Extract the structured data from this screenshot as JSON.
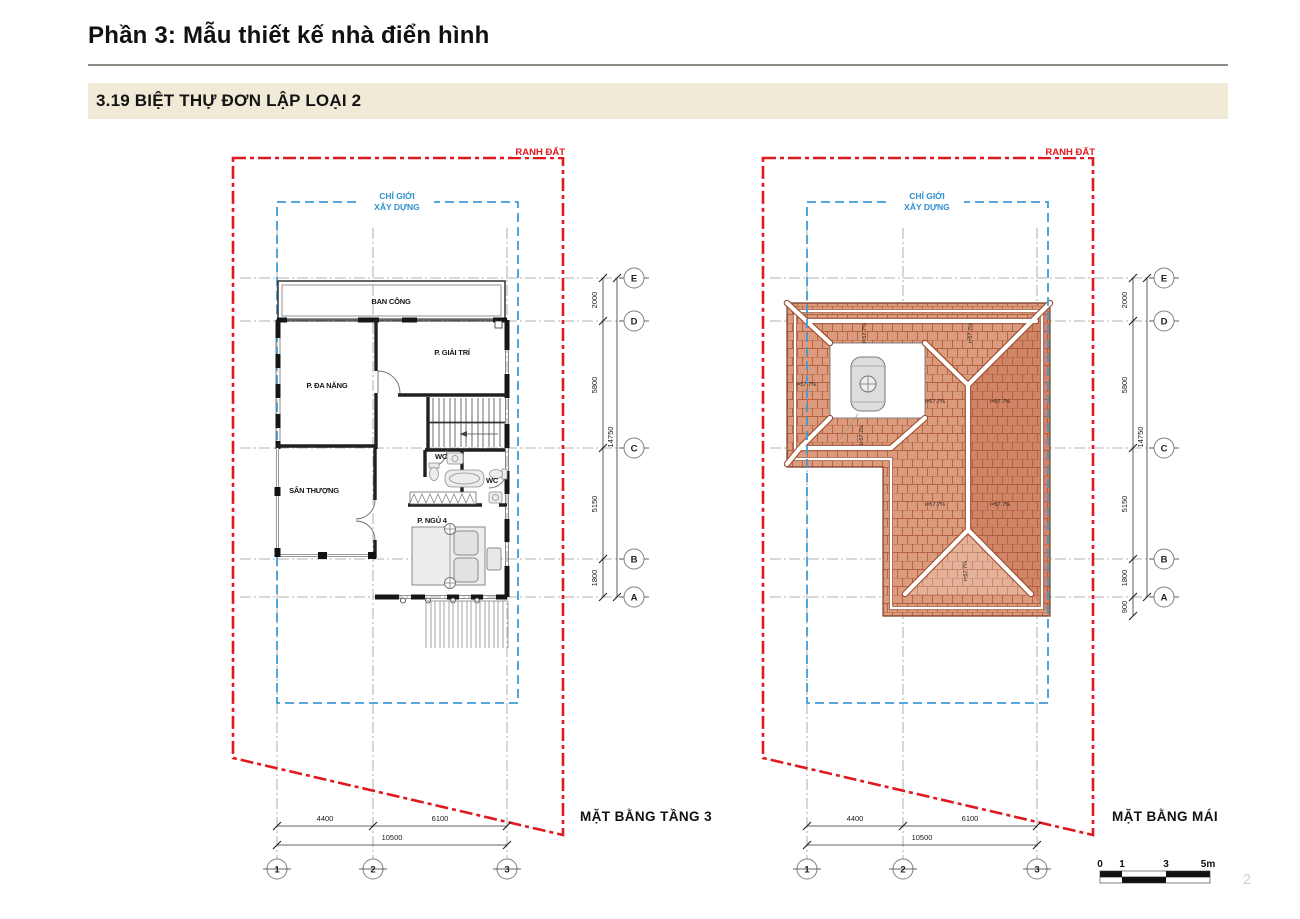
{
  "page": {
    "title": "Phần 3: Mẫu thiết kế nhà điển hình",
    "section": "3.19 BIỆT THỰ ĐƠN LẬP LOẠI 2",
    "page_number": "2"
  },
  "boundaries": {
    "land": "RANH ĐẤT",
    "build_line1": "CHỈ GIỚI",
    "build_line2": "XÂY DỰNG"
  },
  "floor_plan": {
    "title": "MẶT BẰNG TẦNG 3",
    "rooms": {
      "balcony": "BAN CÔNG",
      "entertainment": "P. GIẢI TRÍ",
      "multipurpose": "P. ĐA NĂNG",
      "terrace": "SÂN THƯỢNG",
      "wc1": "WC",
      "wc2": "WC",
      "bedroom": "P. NGỦ 4"
    },
    "grid_rows": [
      "E",
      "D",
      "C",
      "B",
      "A"
    ],
    "grid_cols": [
      "1",
      "2",
      "3"
    ],
    "dims_v": {
      "e_d": "2000",
      "d_c": "5800",
      "c_b": "5150",
      "b_a": "1800",
      "total": "14750"
    },
    "dims_h": {
      "c1_2": "4400",
      "c2_3": "6100",
      "total": "10500"
    }
  },
  "roof_plan": {
    "title": "MẶT BẰNG MÁI",
    "slope_label": "i=57.7%",
    "grid_rows": [
      "E",
      "D",
      "C",
      "B",
      "A"
    ],
    "grid_cols": [
      "1",
      "2",
      "3"
    ],
    "dims_v": {
      "e_d": "2000",
      "d_c": "5800",
      "c_b": "5150",
      "b_a": "1800",
      "a_eave": "900",
      "total": "14750"
    },
    "dims_h": {
      "c1_2": "4400",
      "c2_3": "6100",
      "total": "10500"
    }
  },
  "scale_bar": {
    "t0": "0",
    "t1": "1",
    "t3": "3",
    "t5": "5m"
  }
}
